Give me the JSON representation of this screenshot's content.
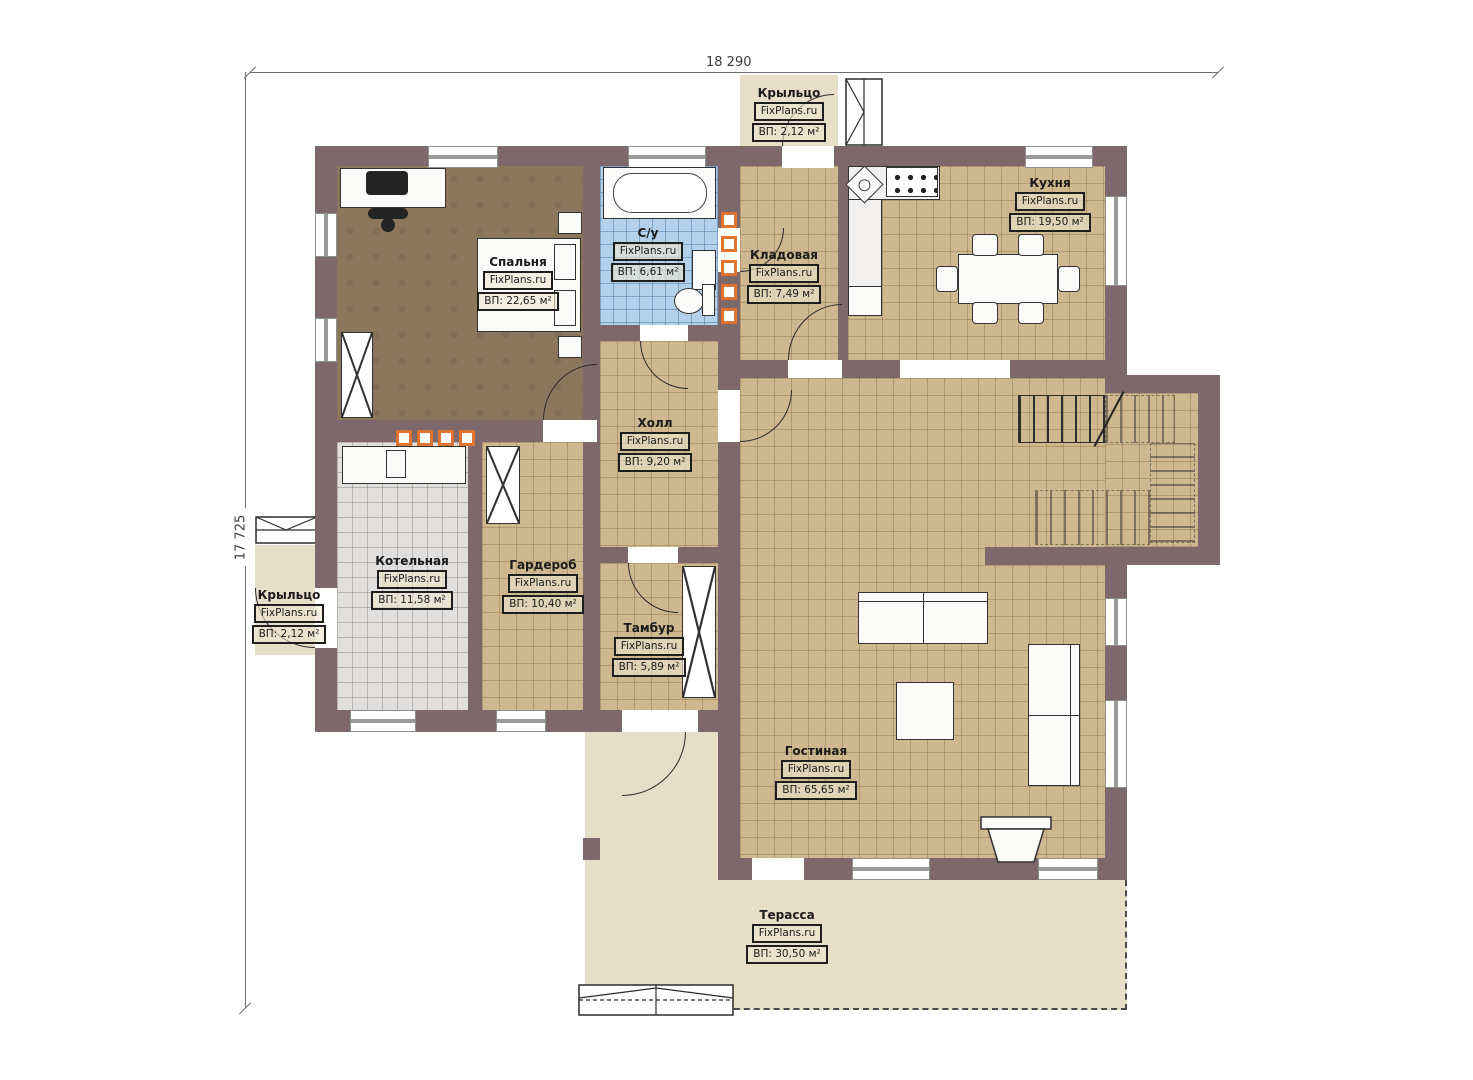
{
  "plan": {
    "type": "floor-plan",
    "brand": "FixPlans.ru",
    "dimensions": {
      "top": "18 290",
      "left": "17 725"
    }
  },
  "rooms": [
    {
      "id": "porch-top",
      "name": "Крыльцо",
      "brand": "FixPlans.ru",
      "area": "ВП: 2,12 м²"
    },
    {
      "id": "bedroom",
      "name": "Спальня",
      "brand": "FixPlans.ru",
      "area": "ВП: 22,65 м²"
    },
    {
      "id": "bathroom",
      "name": "С/у",
      "brand": "FixPlans.ru",
      "area": "ВП: 6,61 м²"
    },
    {
      "id": "storage",
      "name": "Кладовая",
      "brand": "FixPlans.ru",
      "area": "ВП: 7,49 м²"
    },
    {
      "id": "kitchen",
      "name": "Кухня",
      "brand": "FixPlans.ru",
      "area": "ВП: 19,50 м²"
    },
    {
      "id": "hall",
      "name": "Холл",
      "brand": "FixPlans.ru",
      "area": "ВП: 9,20 м²"
    },
    {
      "id": "boiler",
      "name": "Котельная",
      "brand": "FixPlans.ru",
      "area": "ВП: 11,58 м²"
    },
    {
      "id": "wardrobe",
      "name": "Гардероб",
      "brand": "FixPlans.ru",
      "area": "ВП: 10,40 м²"
    },
    {
      "id": "vestibule",
      "name": "Тамбур",
      "brand": "FixPlans.ru",
      "area": "ВП: 5,89 м²"
    },
    {
      "id": "porch-left",
      "name": "Крыльцо",
      "brand": "FixPlans.ru",
      "area": "ВП: 2,12 м²"
    },
    {
      "id": "living",
      "name": "Гостиная",
      "brand": "FixPlans.ru",
      "area": "ВП: 65,65 м²"
    },
    {
      "id": "terrace",
      "name": "Терасса",
      "brand": "FixPlans.ru",
      "area": "ВП: 30,50 м²"
    }
  ],
  "colors": {
    "wall": "#7d696b",
    "tile_tan": "#cdb88f",
    "tile_blue": "#b3d1ea",
    "tile_gray": "#e1dfde",
    "wood_floor": "#8b785c",
    "porch_beige": "#e7deca",
    "radiator_accent": "#df7430"
  }
}
